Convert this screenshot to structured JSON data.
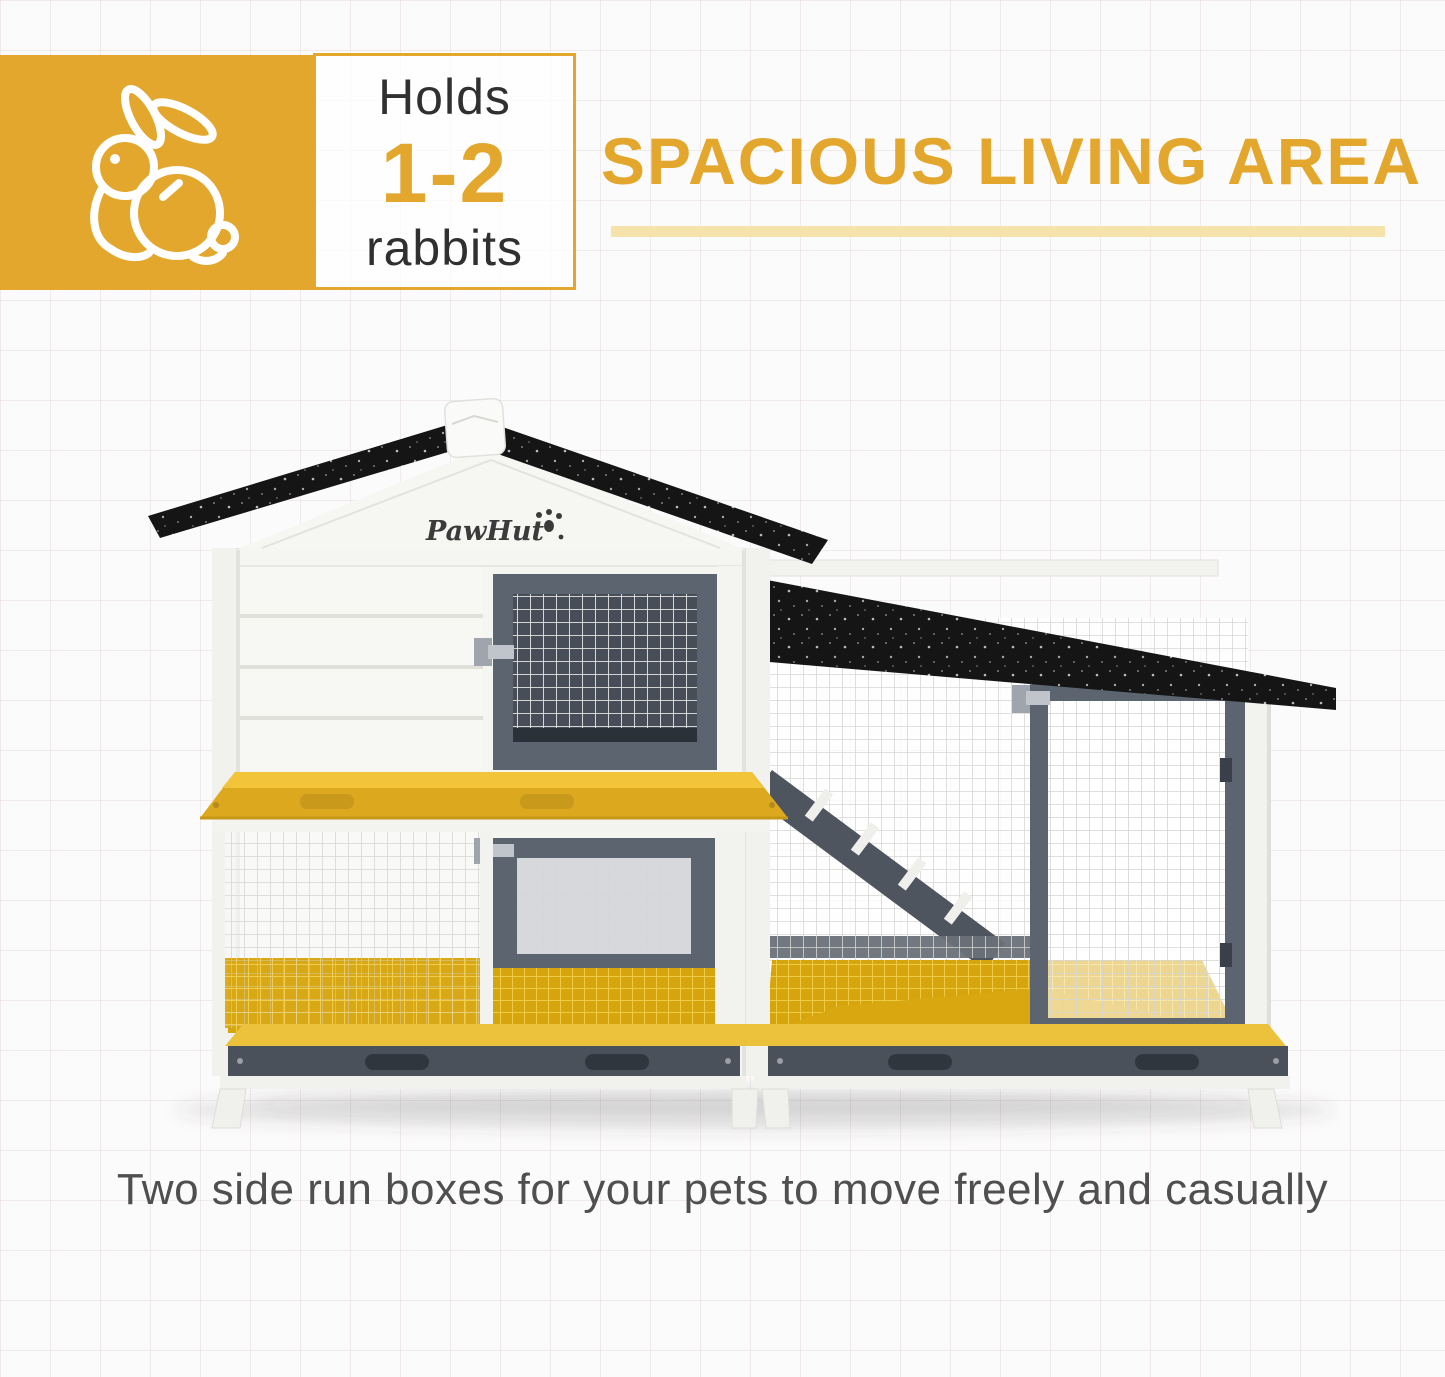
{
  "badge": {
    "icon": "rabbit-icon",
    "holds_label": "Holds",
    "range": "1-2",
    "unit_label": "rabbits"
  },
  "heading": {
    "title": "SPACIOUS LIVING AREA"
  },
  "brand": "PawHut",
  "caption": "Two side run boxes for your pets to move freely and casually",
  "colors": {
    "accent-gold": "#E2A72C",
    "underline-gold": "#F6E3AC",
    "tray-yellow": "#F2C43A",
    "tray-front": "#DCA91E",
    "floor-gold": "#D6A40C",
    "roof-black": "#151515",
    "frame-grey": "#5C646F",
    "frame-grey-dark": "#474E57",
    "base-grey": "#4A515B",
    "wall-white": "#F5F5F2",
    "text-dark": "#303030",
    "caption-grey": "#4F4F4F"
  }
}
